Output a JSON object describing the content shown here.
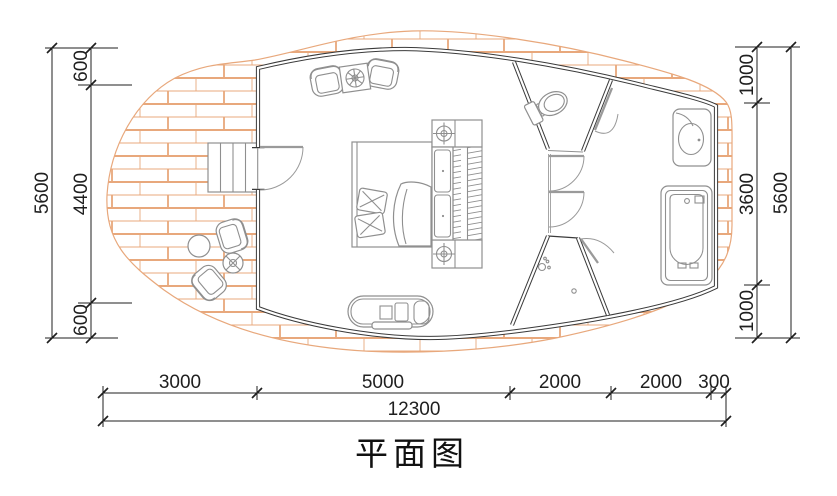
{
  "title": "平面图",
  "colors": {
    "deck_hatch": "#e8a87c",
    "wall": "#3a3a3a",
    "furniture": "#8f8f8f",
    "dimension": "#1f1f1f"
  },
  "dimensions": {
    "left": {
      "total": "5600",
      "segments": [
        "600",
        "4400",
        "600"
      ]
    },
    "right": {
      "total": "5600",
      "segments": [
        "1000",
        "3600",
        "1000"
      ]
    },
    "bottom": {
      "total": "12300",
      "segments": [
        "3000",
        "5000",
        "2000",
        "2000",
        "300"
      ]
    }
  }
}
